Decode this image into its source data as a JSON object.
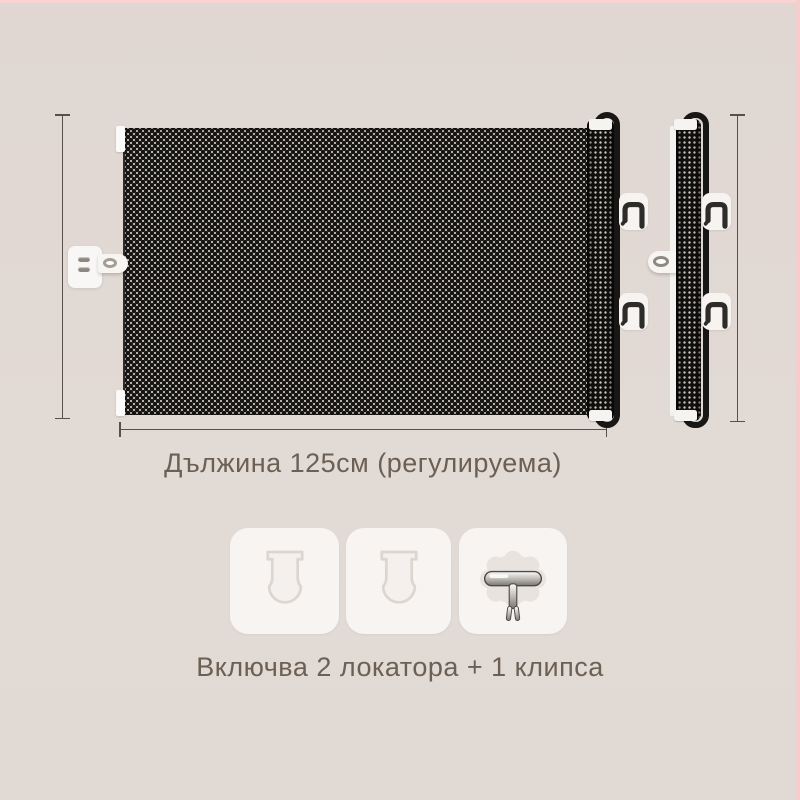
{
  "labels": {
    "length": "Дължина 125см (регулируема)",
    "includes": "Включва 2 локатора + 1 клипса"
  },
  "dimensions": {
    "length_value": "125см",
    "length_note": "регулируема"
  },
  "accessories": {
    "locator_count": 2,
    "clip_count": 1
  },
  "icons": {
    "locator_slot": "locator-slot-icon",
    "metal_clip": "metal-clip-icon",
    "hook_bracket": "hook-icon",
    "latch_tongue": "latch-tongue-icon",
    "screw": "screw-icon"
  },
  "colors": {
    "background": "#e1d8d3",
    "accent_strip": "#f8d3d2",
    "mesh_dark": "#161514",
    "frame_black": "#191715",
    "text": "#6c5f54",
    "dimension_line": "#5a5048",
    "tile_background": "#f7f4f2",
    "pad_white": "#f6f3f0"
  }
}
